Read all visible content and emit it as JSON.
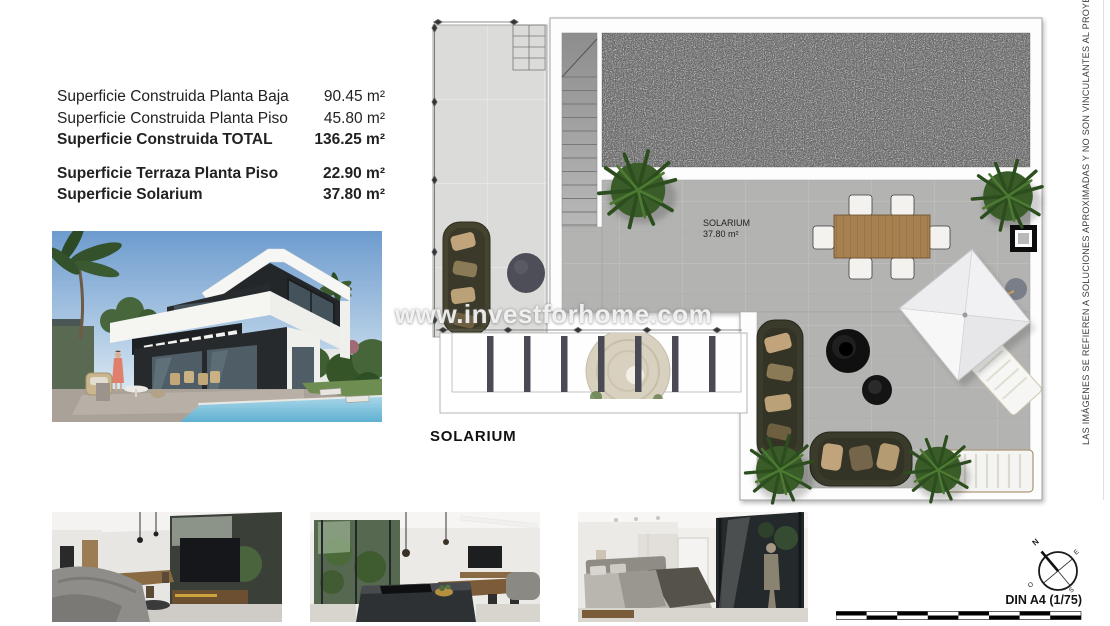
{
  "header": {
    "area_rows": [
      {
        "label": "Superficie Construida Planta Baja",
        "value": "90.45 m²"
      },
      {
        "label": "Superficie Construida Planta Piso",
        "value": "45.80 m²"
      },
      {
        "label": "Superficie Construida TOTAL",
        "value": "136.25 m²"
      },
      {
        "label": "Superficie Terraza Planta Piso",
        "value": "22.90 m²"
      },
      {
        "label": "Superficie Solarium",
        "value": "37.80 m²"
      }
    ]
  },
  "plan": {
    "room_label": "SOLARIUM",
    "room_area": "37.80 m²",
    "title": "SOLARIUM"
  },
  "watermark": {
    "text": "www.investforhome.com"
  },
  "disclaimer": {
    "text": "LAS IMÁGENES SE REFIEREN A SOLUCIONES APROXIMADAS Y NO SON VINCULANTES AL PROYECTO FINAL"
  },
  "compass": {
    "north": "N",
    "east": "E",
    "south": "S",
    "west": "O"
  },
  "footer": {
    "format_label": "DIN A4 (1/75)"
  },
  "colors": {
    "page_bg": "#ffffff",
    "solarium_tile": "#b3b3b2",
    "terrace_tile": "#dbdbd9",
    "gravel": "#d0d0d0",
    "sofa_olive": "#3b3b2b",
    "wood_table": "#a6804f",
    "plant_green": "#3a5c28",
    "watermark_gray": "#e8e8e8"
  }
}
